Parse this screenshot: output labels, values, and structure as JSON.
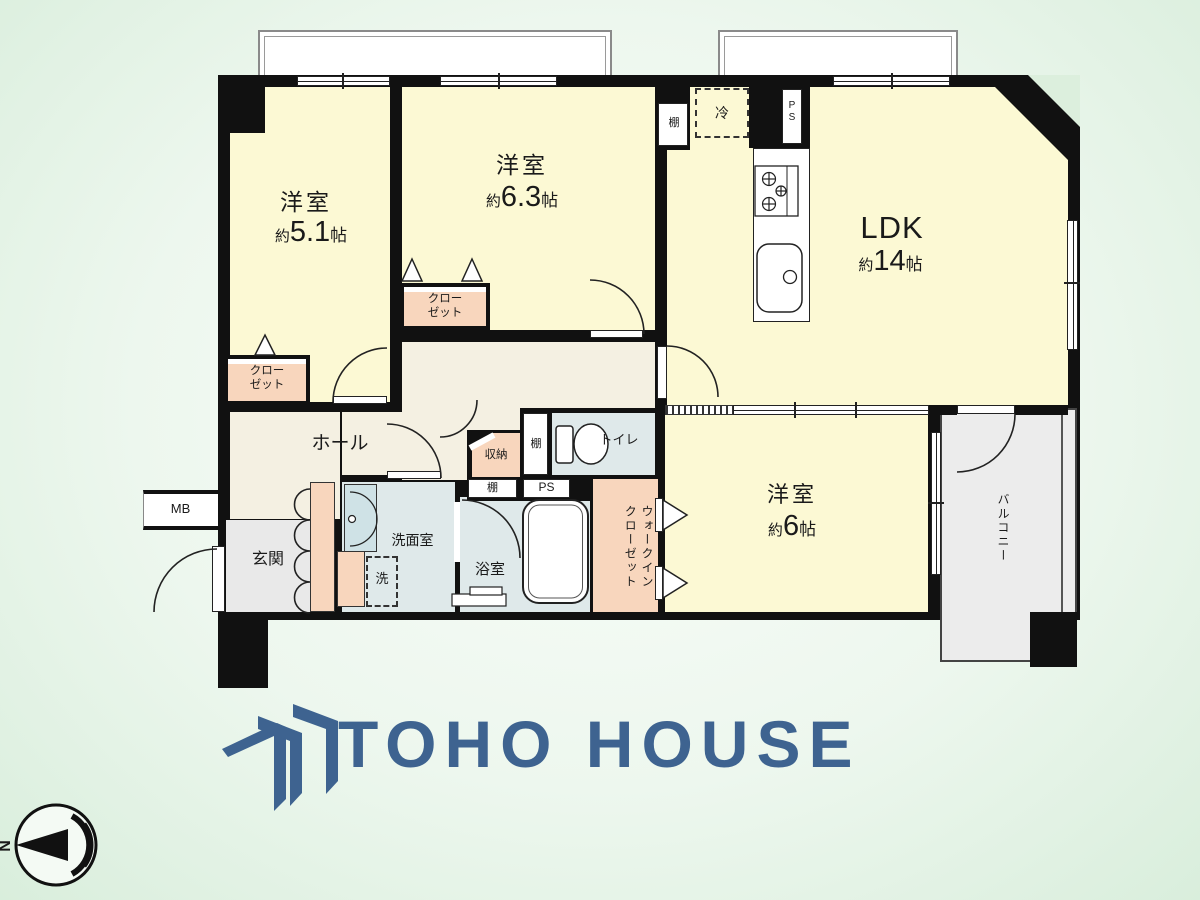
{
  "plan": {
    "bedroom1": {
      "name": "洋室",
      "approx": "約",
      "num": "5.1",
      "unit": "帖"
    },
    "bedroom2": {
      "name": "洋室",
      "approx": "約",
      "num": "6.3",
      "unit": "帖"
    },
    "bedroom3": {
      "name": "洋室",
      "approx": "約",
      "num": "6",
      "unit": "帖"
    },
    "ldk": {
      "name": "LDK",
      "approx": "約",
      "num": "14",
      "unit": "帖"
    },
    "hall": "ホール",
    "entrance": "玄関",
    "washroom": "洗面室",
    "bath": "浴室",
    "toilet": "トイレ",
    "storage": "収納",
    "walk_in_closet": "ウォークイン\nクローゼット",
    "balcony": "バルコニー",
    "closet1": "クロー\nゼット",
    "closet2": "クロー\nゼット",
    "shelf_kitchen": "棚",
    "shelf_hall": "棚",
    "shelf_wall": "棚",
    "ps_kitchen": "P\nS",
    "ps_wall": "PS",
    "refrigerator": "冷",
    "meter_box": "MB",
    "washer": "洗"
  },
  "logo": {
    "text": "TOHO HOUSE"
  },
  "compass": {
    "north": "N"
  },
  "colors": {
    "logo_blue": "#3e6390",
    "room_yellow": "#fcf9d4",
    "closet_pink": "#f8d6bd",
    "wet_blue": "#dfe9ea",
    "hall_beige": "#f4f0e2",
    "wall_black": "#111111"
  }
}
